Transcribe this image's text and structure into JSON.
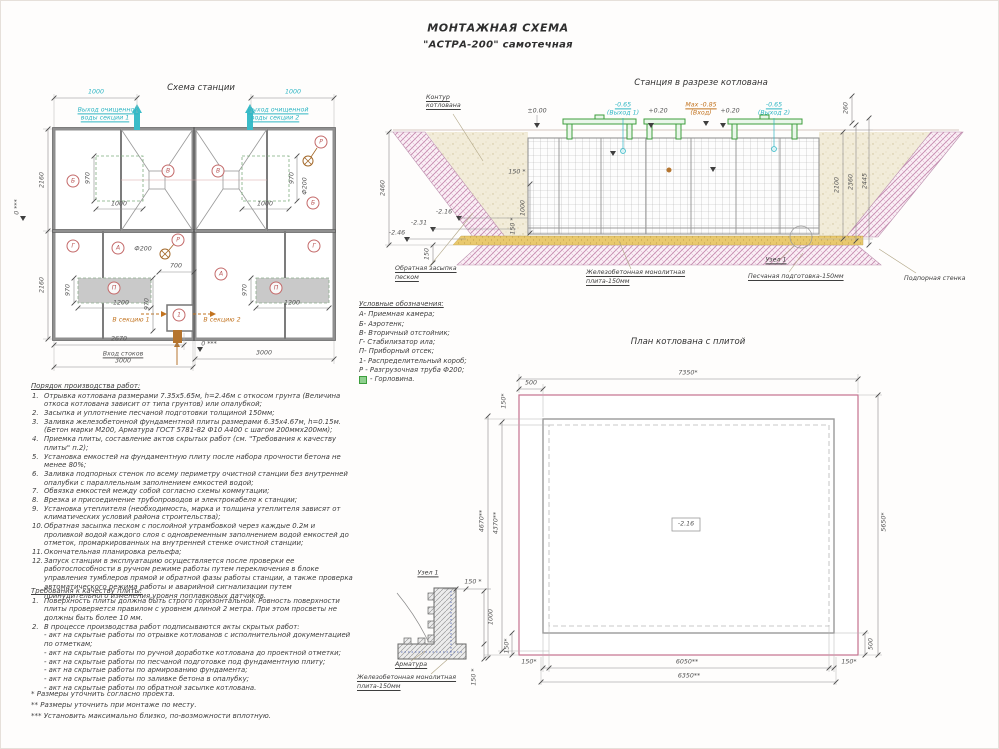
{
  "title": {
    "line1": "МОНТАЖНАЯ СХЕМА",
    "line2": "\"АСТРА-200\" самотечная"
  },
  "station_plan": {
    "title": "Схема станции",
    "outlet1a": "Выход очищенной",
    "outlet1b": "воды секции 1",
    "outlet2a": "Выход очищенной",
    "outlet2b": "воды секции 2",
    "to_section1": "В секцию 1",
    "to_section2": "В секцию 2",
    "inlet": "Вход стоков",
    "zero": "0 ***",
    "dims": {
      "d1000": "1000",
      "d2160": "2160",
      "d970": "970",
      "d700": "700",
      "d1200": "1200",
      "d2670": "2670",
      "d3000": "3000",
      "phi200": "Ф200"
    },
    "tags": {
      "A": "А",
      "B": "Б",
      "V": "В",
      "G": "Г",
      "P": "П",
      "R": "Р",
      "one": "1"
    }
  },
  "section_view": {
    "title": "Станция в разрезе котлована",
    "contour1": "Контур",
    "contour2": "котлована",
    "levels": {
      "zero": "±0.00",
      "out1a": "-0.65",
      "out1b": "(Выход 1)",
      "plus020": "+0.20",
      "in_a": "Max -0.85",
      "in_b": "(Вход)",
      "out2a": "-0.65",
      "out2b": "(Выход 2)",
      "m216": "-2.16",
      "m231": "-2.31",
      "m246": "-2.46"
    },
    "dims": {
      "d260": "260",
      "d2100": "2100",
      "d2360": "2360",
      "d2445": "2445",
      "d2460": "2460",
      "d150s": "150 *",
      "d1000": "1000",
      "d150": "150"
    },
    "labels": {
      "backfill1": "Обратная засыпка",
      "backfill2": "песком",
      "slab1": "Железобетонная монолитная",
      "slab2": "плита-150мм",
      "node": "Узел 1",
      "sand": "Песчаная подготовка-150мм",
      "wall": "Подпорная стенка"
    }
  },
  "legend": {
    "title": "Условные обозначения:",
    "items": [
      "А- Приемная камера;",
      "Б- Аэротенк;",
      "В- Вторичный отстойник;",
      "Г- Стабилизатор ила;",
      "П- Приборный отсек;",
      "1- Распределительный короб;",
      "Р - Разгрузочная труба Ф200;"
    ],
    "gorlovina": "- Горловина."
  },
  "pit_plan": {
    "title": "План котлована с плитой",
    "elevation": "-2.16",
    "dims": {
      "top": "7350*",
      "d500": "500",
      "d150": "150*",
      "left_outer": "4670**",
      "left_inner": "4370**",
      "right": "5650*",
      "bottom_mid": "6050**",
      "bottom_total": "6350**"
    }
  },
  "node_detail": {
    "title": "Узел 1",
    "rebar": "Арматура",
    "slab1": "Железобетонная монолитная",
    "slab2": "плита-150мм",
    "d150": "150 *",
    "d1000": "1000"
  },
  "work_order": {
    "title": "Порядок производства работ:",
    "items": [
      {
        "n": "1.",
        "t": "Отрывка котлована размерами 7.35х5.65м, h=2.46м с откосом грунта (Величина откоса котлована зависит от типа грунтов) или опалубкой;"
      },
      {
        "n": "2.",
        "t": "Засыпка и уплотнение песчаной подготовки толщиной 150мм;"
      },
      {
        "n": "3.",
        "t": "Заливка железобетонной фундаментной плиты размерами 6.35х4.67м, h=0.15м. (Бетон марки М200, Арматура ГОСТ 5781-82 Ф10 А400 с шагом 200ммх200мм);"
      },
      {
        "n": "4.",
        "t": "Приемка плиты, составление актов скрытых работ (см. \"Требования к качеству плиты\" п.2);"
      },
      {
        "n": "5.",
        "t": "Установка емкостей на фундаментную плиту после набора прочности бетона не менее 80%;"
      },
      {
        "n": "6.",
        "t": "Заливка подпорных стенок по всему периметру очистной станции без внутренней опалубки с параллельным заполнением емкостей водой;"
      },
      {
        "n": "7.",
        "t": "Обвязка емкостей между собой согласно схемы коммутации;"
      },
      {
        "n": "8.",
        "t": "Врезка и присоединение трубопроводов и электрокабеля к станции;"
      },
      {
        "n": "9.",
        "t": "Установка утеплителя (необходимость, марка и толщина утеплителя зависят от климатических условий района строительства);"
      },
      {
        "n": "10.",
        "t": "Обратная засыпка песком с послойной утрамбовкой через каждые 0.2м и проливкой водой каждого слоя с одновременным заполнением водой емкостей до отметок, промаркированных на внутренней стенке очистной станции;"
      },
      {
        "n": "11.",
        "t": "Окончательная планировка рельефа;"
      },
      {
        "n": "12.",
        "t": "Запуск станции в эксплуатацию осуществляется после проверки ее работоспособности в ручном режиме работы путем переключения в блоке управления тумблеров прямой и обратной фазы работы станции, а также проверка автоматического режима работы и аварийной сигнализации путем принудительного изменения уровня поплавковых датчиков."
      }
    ]
  },
  "quality": {
    "title": "Требования к качеству плиты:",
    "items": [
      {
        "n": "1.",
        "t": "Поверхность плиты должна быть строго горизонтальной. Ровность поверхности плиты проверяется правилом с уровнем длиной 2 метра. При этом просветы не должны быть более 10 мм."
      },
      {
        "n": "2.",
        "t": "В процессе производства работ подписываются акты скрытых работ:"
      }
    ],
    "acts": [
      "- акт на скрытые работы по отрывке котлованов с исполнительной документацией по отметкам;",
      "- акт на скрытые работы по ручной доработке котлована до проектной отметки;",
      "- акт на скрытые работы по песчаной подготовке под фундаментную плиту;",
      "- акт на скрытые работы по армированию фундамента;",
      "- акт на скрытые работы по заливке бетона в опалубку;",
      "- акт на скрытые работы по обратной засыпке котлована."
    ]
  },
  "notes": {
    "n1": "*  Размеры уточнить согласно проекта.",
    "n2": "**  Размеры уточнить при монтаже по месту.",
    "n3": "***  Установить максимально близко, по-возможности вплотную."
  }
}
